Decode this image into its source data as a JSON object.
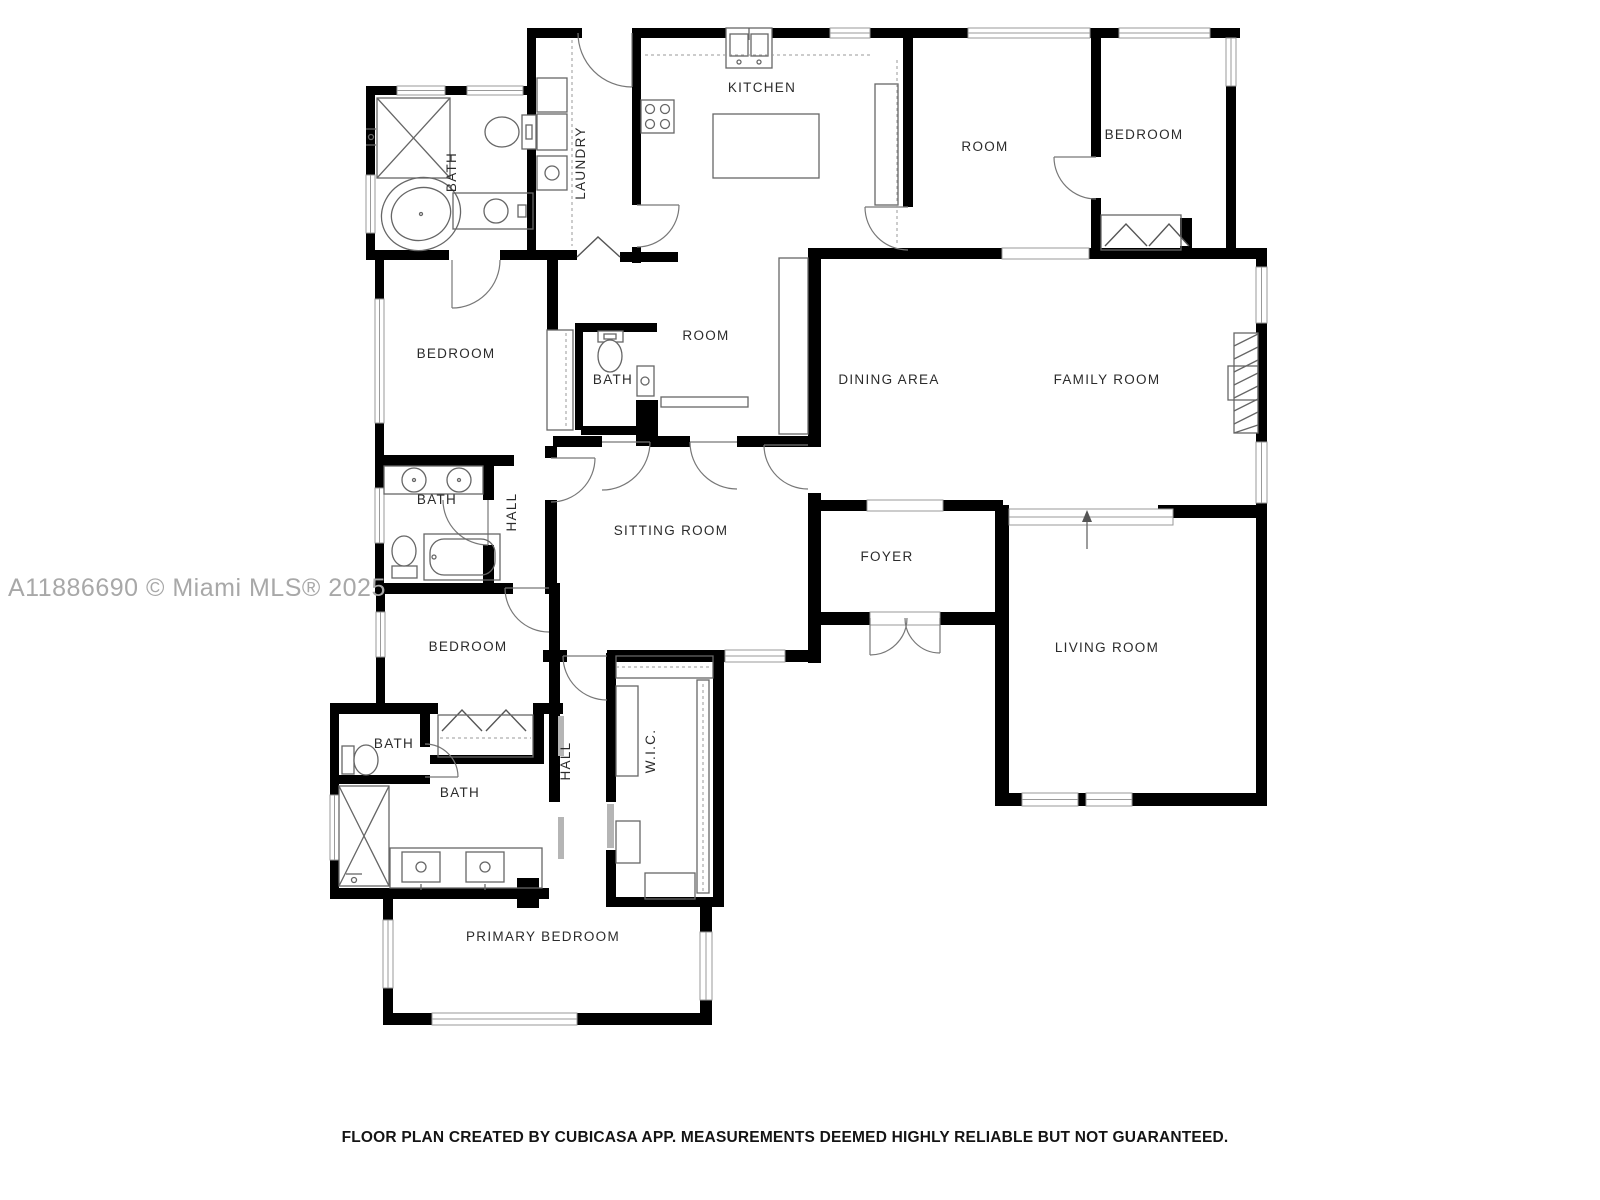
{
  "watermark": {
    "text": "A11886690 © Miami MLS® 2025"
  },
  "footer": {
    "text": "FLOOR PLAN CREATED BY CUBICASA APP. MEASUREMENTS DEEMED HIGHLY RELIABLE BUT NOT GUARANTEED."
  },
  "rooms": [
    {
      "label": "KITCHEN"
    },
    {
      "label": "ROOM"
    },
    {
      "label": "BEDROOM"
    },
    {
      "label": "BATH"
    },
    {
      "label": "LAUNDRY"
    },
    {
      "label": "BEDROOM"
    },
    {
      "label": "BATH"
    },
    {
      "label": "ROOM"
    },
    {
      "label": "DINING AREA"
    },
    {
      "label": "FAMILY ROOM"
    },
    {
      "label": "BATH"
    },
    {
      "label": "HALL"
    },
    {
      "label": "SITTING ROOM"
    },
    {
      "label": "FOYER"
    },
    {
      "label": "LIVING ROOM"
    },
    {
      "label": "BEDROOM"
    },
    {
      "label": "BATH"
    },
    {
      "label": "BATH"
    },
    {
      "label": "HALL"
    },
    {
      "label": "W.I.C."
    },
    {
      "label": "PRIMARY BEDROOM"
    }
  ],
  "colors": {
    "wall": "#000000",
    "fixture": "#666666",
    "watermark": "#a8a8a8",
    "background": "#ffffff"
  }
}
